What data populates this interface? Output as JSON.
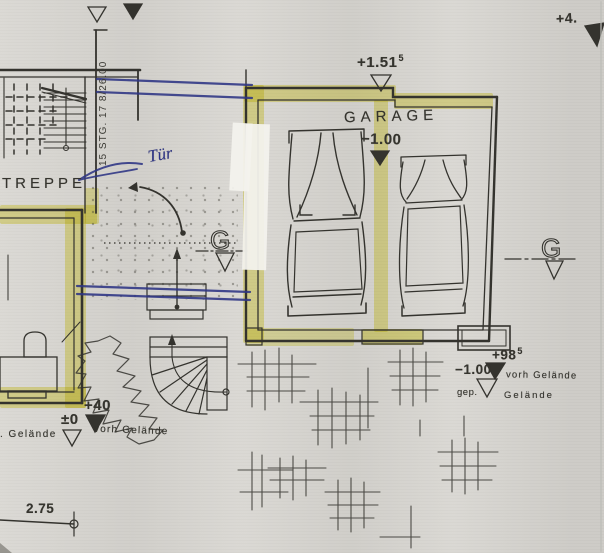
{
  "document": {
    "kind": "scanned site plan with garage and stairs"
  },
  "labels": {
    "garage": "GARAGE",
    "treppe": "TREPPE",
    "stair_spec": "15 STG. 17 8/26.00",
    "tuer_note": "Tür",
    "dim_width": "2.75",
    "g_symbol": "G"
  },
  "elevations": {
    "top_right": "+4.",
    "garage_entry_main": "+1.51",
    "garage_entry_sup": "5",
    "garage_floor": "−1.00",
    "yard_right_high_main": "+98",
    "yard_right_high_sup": "5",
    "yard_right_low": "−1.00",
    "yard_right_vorh": "vorh Gelände",
    "yard_right_gep": "gep.",
    "yard_right_gelaende": "Gelände",
    "yard_left_plus40": "+40",
    "yard_left_zero": "±0",
    "yard_left_gelaende": ". Gelände",
    "yard_left_vorh": "vorh Gelände"
  },
  "colors": {
    "paper": "#d8d6d1",
    "ink": "#34332e",
    "blue_ink": "#2e3585",
    "highlighter": "#e7e14e",
    "whiteout": "#f3f2ed"
  }
}
